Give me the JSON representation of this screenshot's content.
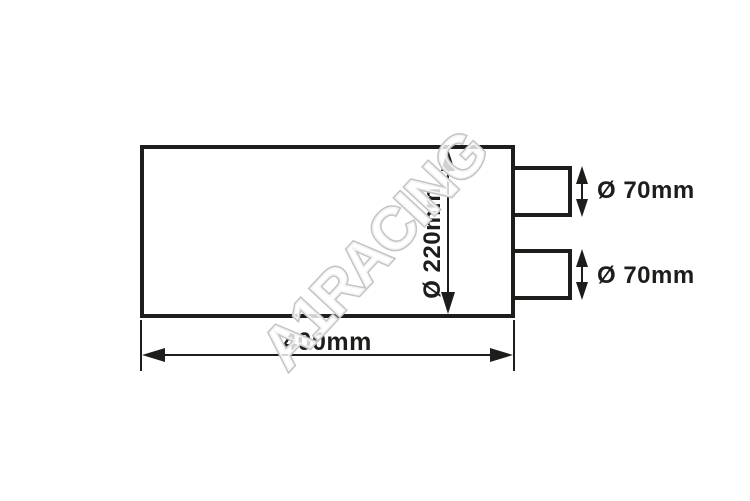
{
  "diagram": {
    "watermark": "A1RACING",
    "dimensions": {
      "length": "400mm",
      "body_diameter": "Ø 220mm",
      "outlet_top_diameter": "Ø 70mm",
      "outlet_bottom_diameter": "Ø 70mm"
    },
    "colors": {
      "line": "#1d1d1b",
      "text": "#1d1d1b",
      "background": "#ffffff",
      "watermark_fill": "#ffffff",
      "watermark_stroke": "#c4c4c4"
    }
  }
}
